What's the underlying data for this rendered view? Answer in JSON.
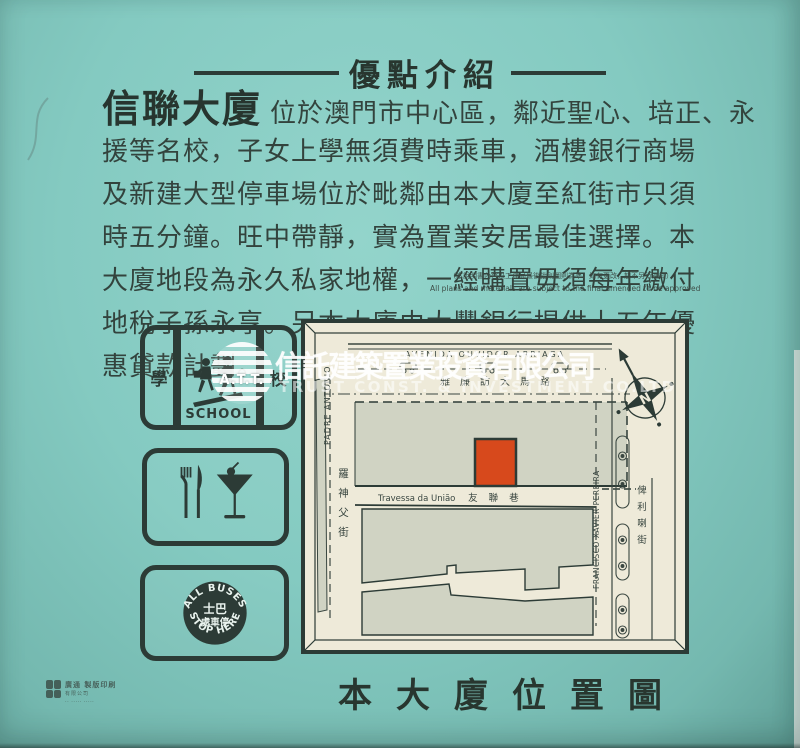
{
  "colors": {
    "background_teal": "#84cac1",
    "ink": "#2c3b36",
    "map_paper": "#eeead9",
    "map_block_gray": "#d0d3c3",
    "building_red": "#d7491c",
    "watermark_white": "#ffffff"
  },
  "header": {
    "title": "優點介紹"
  },
  "intro": {
    "lead": "信聯大廈",
    "lines": {
      "l1": "位於澳門市中心區，鄰近聖心、培正、永",
      "l2": "援等名校，子女上學無須費時乘車，酒樓銀行商場",
      "l3": "及新建大型停車場位於毗鄰由本大廈至紅街市只須",
      "l4": "時五分鐘。旺中帶靜，實為置業安居最佳選擇。本",
      "l5": "大廈地段為永久私家地權，一經購置毋須每年繳付",
      "l6": "地稅子孫永享。另本大廈由大豐銀行提供十五年優",
      "l7": "惠貸款計劃。"
    }
  },
  "disclaimer": {
    "zh": "（本說明書內容以工務局最後批則圖則為準，如有更改，恕不另行通知）",
    "en": "All plans and materials are subject to the final amended to be approved"
  },
  "signs": {
    "school": {
      "left_char": "學",
      "right_char": "校",
      "caption": "SCHOOL"
    },
    "bus": {
      "arc_top": "ALL BUSES",
      "arc_bottom": "STOP HERE",
      "center_top": "士巴",
      "center_bottom": "處車停"
    }
  },
  "map": {
    "avenida_en": "AVENIDA OUVIDOR ARRIAGA",
    "avenida_zh": "雅廉訪大馬路",
    "padre_en": "PADRE ANTONIO",
    "padre_zh": "羅神父街",
    "travessa_en": "Travessa da União",
    "travessa_zh": "友聯巷",
    "francisco_en": "FRANCISCO XAVIER PEREIRA",
    "francisco_zh": "俾利喇街",
    "compass": "N"
  },
  "watermark": {
    "logo": "A.T.T.",
    "zh": "信託建築置業投資有限公司",
    "en": "TRUST CONST. & INVESTMENT CO.LTD"
  },
  "footer": {
    "title": "本大廈位置圖"
  },
  "printer": {
    "line1": "廣通 製版印刷",
    "line2": "有限公司",
    "line3": "·· ····· ·····"
  }
}
